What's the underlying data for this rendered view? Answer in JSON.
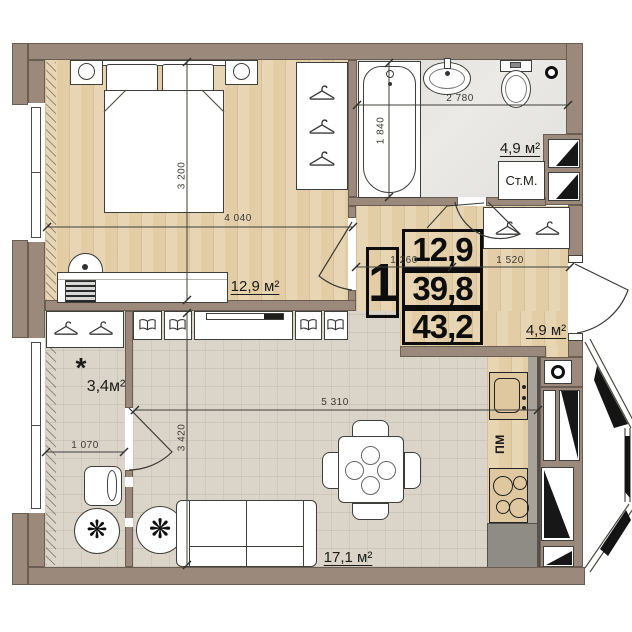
{
  "plan": {
    "stamp": {
      "rooms": "1",
      "living": "12,9",
      "area": "39,8",
      "total": "43,2"
    },
    "areas": {
      "bedroom": "12,9 м²",
      "bathroom": "4,9 м²",
      "hallway": "4,9 м²",
      "living": "17,1 м²",
      "balcony": "3,4м²",
      "balcony_note": "*"
    },
    "appliances": {
      "washing_machine": "Ст.М.",
      "dishwasher": "ПМ"
    },
    "dimensions": {
      "bedroom_w": "4 040",
      "bedroom_h": "3 200",
      "bathroom_w": "2 780",
      "bathtub_l": "1 840",
      "hall_seg1": "1 260",
      "hall_seg2": "1 520",
      "living_w": "5 310",
      "living_h": "3 420",
      "balcony_w": "1 070"
    },
    "icons": {
      "plant": "❋"
    },
    "colors": {
      "wall": "#9b8a7c",
      "wood": "#e3cda6",
      "tile": "#dbd4c9",
      "bath": "#ebeae7",
      "counter": "#8f8c85"
    }
  }
}
